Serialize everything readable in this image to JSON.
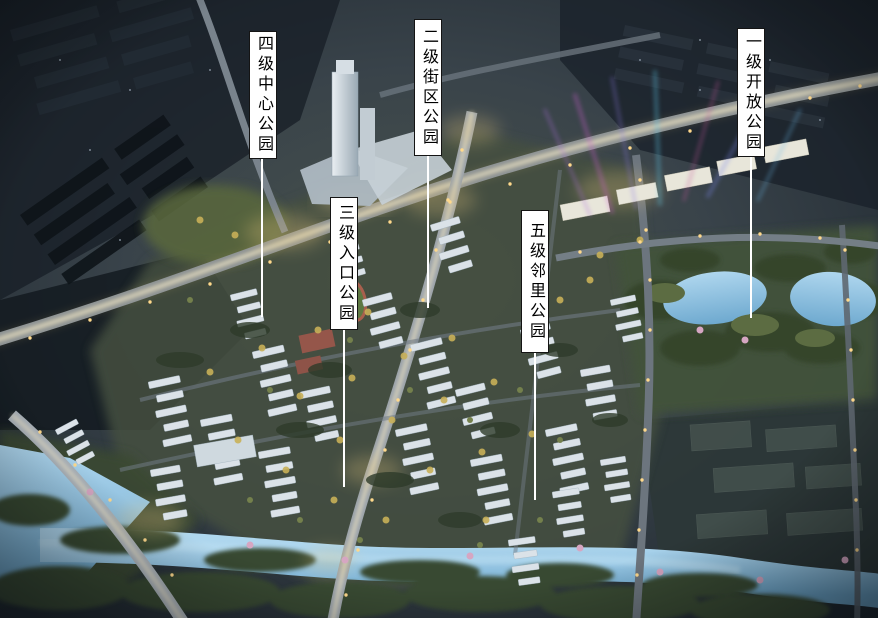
{
  "colors": {
    "background": "#29323c",
    "water": "#8fc3e2",
    "road_glow": "#f0e4bc",
    "label_background": "#ffffff",
    "label_border": "#141414",
    "label_text": "#000000",
    "leader_line": "#ffffff"
  },
  "callouts": [
    {
      "id": "level-4-central-park",
      "text": "四级中心公园"
    },
    {
      "id": "level-2-block-park",
      "text": "二级街区公园"
    },
    {
      "id": "level-1-open-park",
      "text": "一级开放公园"
    },
    {
      "id": "level-3-entrance-park",
      "text": "三级入口公园"
    },
    {
      "id": "level-5-neighborhood-park",
      "text": "五级邻里公园"
    }
  ]
}
